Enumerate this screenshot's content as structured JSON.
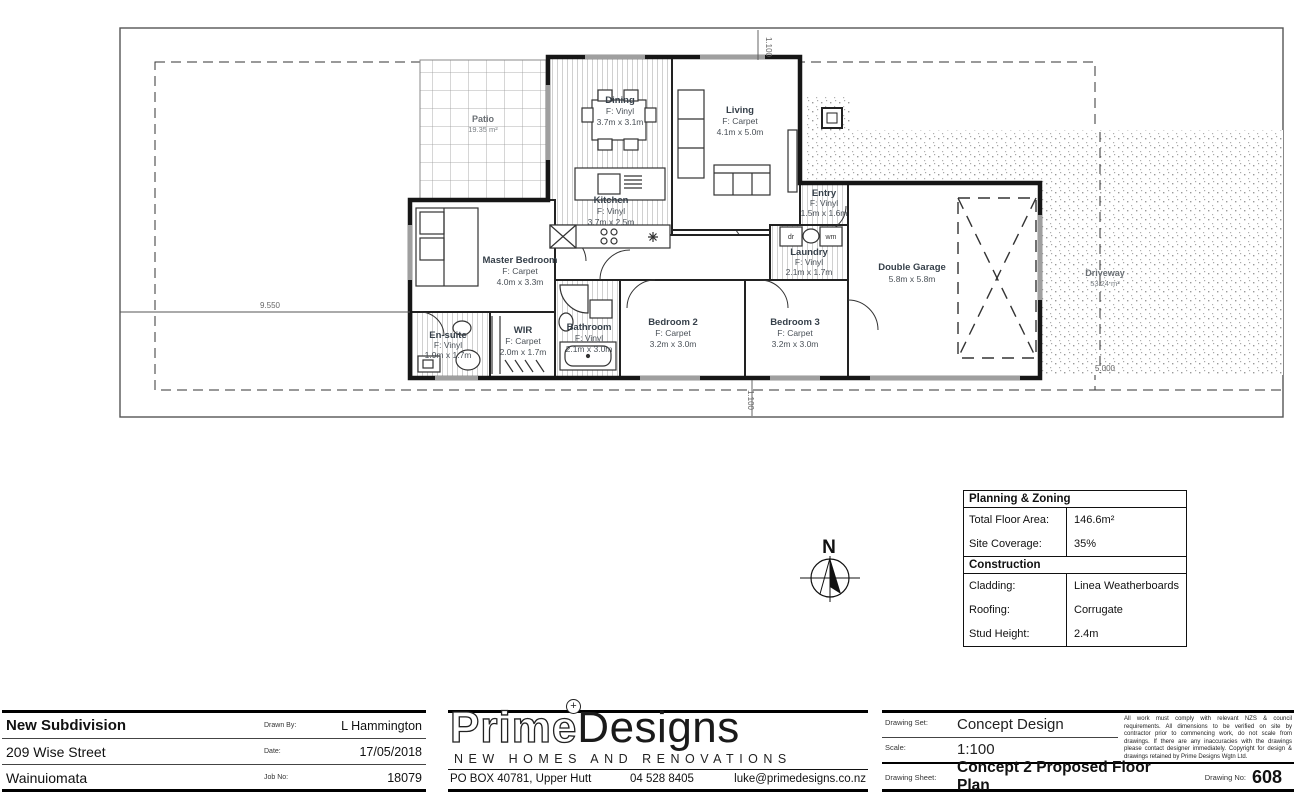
{
  "plan": {
    "rooms": {
      "dining": {
        "name": "Dining",
        "floor": "F: Vinyl",
        "dims": "3.7m x 3.1m"
      },
      "living": {
        "name": "Living",
        "floor": "F: Carpet",
        "dims": "4.1m x 5.0m"
      },
      "kitchen": {
        "name": "Kitchen",
        "floor": "F: Vinyl",
        "dims": "3.7m x 2.5m"
      },
      "entry": {
        "name": "Entry",
        "floor": "F: Vinyl",
        "dims": "1.5m x 1.6m"
      },
      "laundry": {
        "name": "Laundry",
        "floor": "F: Vinyl",
        "dims": "2.1m x 1.7m"
      },
      "master": {
        "name": "Master Bedroom",
        "floor": "F: Carpet",
        "dims": "4.0m x 3.3m"
      },
      "ensuite": {
        "name": "En-suite",
        "floor": "F: Vinyl",
        "dims": "1.9m x 1.7m"
      },
      "wir": {
        "name": "WIR",
        "floor": "F: Carpet",
        "dims": "2.0m x 1.7m"
      },
      "bathroom": {
        "name": "Bathroom",
        "floor": "F: Vinyl",
        "dims": "2.1m x 3.0m"
      },
      "bedroom2": {
        "name": "Bedroom 2",
        "floor": "F: Carpet",
        "dims": "3.2m x 3.0m"
      },
      "bedroom3": {
        "name": "Bedroom 3",
        "floor": "F: Carpet",
        "dims": "3.2m x 3.0m"
      },
      "garage": {
        "name": "Double Garage",
        "dims": "5.8m x 5.8m"
      }
    },
    "outdoor": {
      "patio": {
        "name": "Patio",
        "area": "19.35 m²"
      },
      "driveway": {
        "name": "Driveway",
        "area": "53.24 m²"
      }
    },
    "appliances": {
      "dryer": "dr",
      "washer": "wm"
    },
    "dimensions": {
      "left": "9.550",
      "top": "1.100",
      "bottom": "1.100",
      "right": "5.000"
    },
    "north_label": "N"
  },
  "info_table": {
    "planning": {
      "title": "Planning & Zoning",
      "rows": [
        {
          "label": "Total Floor Area:",
          "value": "146.6m²"
        },
        {
          "label": "Site Coverage:",
          "value": "35%"
        }
      ]
    },
    "construction": {
      "title": "Construction",
      "rows": [
        {
          "label": "Cladding:",
          "value": "Linea Weatherboards"
        },
        {
          "label": "Roofing:",
          "value": "Corrugate"
        },
        {
          "label": "Stud Height:",
          "value": "2.4m"
        }
      ]
    }
  },
  "title_block": {
    "project": {
      "line1": "New Subdivision",
      "line2": "209 Wise Street",
      "line3": "Wainuiomata",
      "drawn_by_label": "Drawn By:",
      "drawn_by": "L Hammington",
      "date_label": "Date:",
      "date": "17/05/2018",
      "job_no_label": "Job No:",
      "job_no": "18079"
    },
    "company": {
      "name_prime": "Prime",
      "name_designs": "Designs",
      "plus": "+",
      "tagline": "NEW HOMES AND RENOVATIONS",
      "address": "PO BOX 40781, Upper Hutt",
      "phone": "04 528 8405",
      "email": "luke@primedesigns.co.nz"
    },
    "drawing": {
      "set_label": "Drawing Set:",
      "set": "Concept Design",
      "scale_label": "Scale:",
      "scale": "1:100",
      "sheet_label": "Drawing Sheet:",
      "sheet": "Concept 2 Proposed Floor Plan",
      "no_label": "Drawing No:",
      "no": "608",
      "disclaimer": "All work must comply with relevant NZS & council requirements. All dimensions to be verified on site by contractor prior to commencing work, do not scale from drawings. If there are any inaccuracies with the drawings please contact designer immediately. Copyright for design & drawings retained by Prime Designs Wgtn Ltd."
    }
  }
}
